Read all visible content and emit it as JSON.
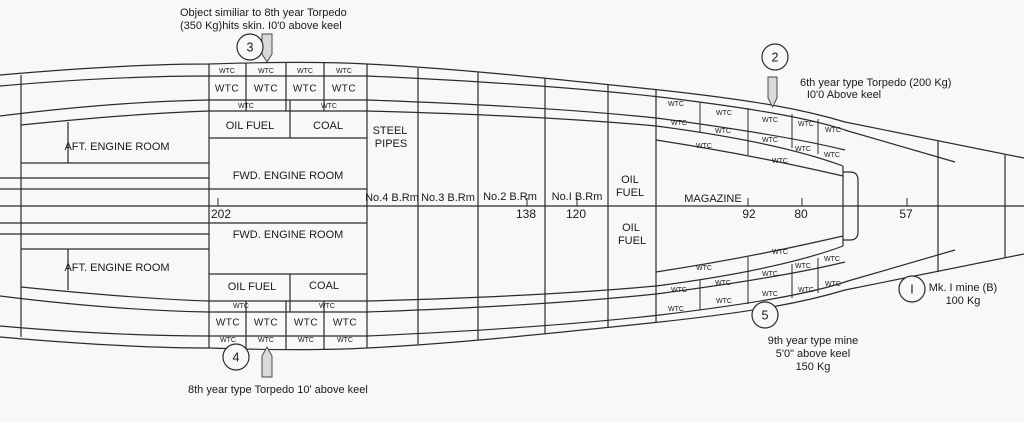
{
  "colors": {
    "bg": "#f8f8f8",
    "line": "#2b2b2b",
    "text": "#1a1a1a",
    "torpedo_fill": "#d9d9d9"
  },
  "compartments": {
    "aft_engine_room_top": "AFT. ENGINE ROOM",
    "aft_engine_room_bottom": "AFT. ENGINE ROOM",
    "fwd_engine_room_top": "FWD. ENGINE ROOM",
    "fwd_engine_room_bottom": "FWD. ENGINE ROOM",
    "oil_fuel_top": "OIL FUEL",
    "coal_top": "COAL",
    "oil_fuel_bottom": "OIL FUEL",
    "coal_bottom": "COAL",
    "steel_pipes_line1": "STEEL",
    "steel_pipes_line2": "PIPES",
    "boiler_room_4": "No.4 B.Rm",
    "boiler_room_3": "No.3 B.Rm",
    "boiler_room_2": "No.2 B.Rm",
    "boiler_room_1": "No.I B.Rm",
    "oil_col_top_line1": "OIL",
    "oil_col_top_line2": "FUEL",
    "oil_col_bottom_line1": "OIL",
    "oil_col_bottom_line2": "FUEL",
    "magazine": "MAGAZINE"
  },
  "frame_numbers": [
    {
      "x": 221,
      "y": 215,
      "t": "202"
    },
    {
      "x": 526,
      "y": 215,
      "t": "138"
    },
    {
      "x": 576,
      "y": 215,
      "t": "120"
    },
    {
      "x": 749,
      "y": 215,
      "t": "92"
    },
    {
      "x": 801,
      "y": 215,
      "t": "80"
    },
    {
      "x": 906,
      "y": 215,
      "t": "57"
    }
  ],
  "wtc_labels": [
    {
      "x": 227,
      "y": 71,
      "t": "WTC",
      "cls": "wtc-xs"
    },
    {
      "x": 266,
      "y": 71,
      "t": "WTC",
      "cls": "wtc-xs"
    },
    {
      "x": 305,
      "y": 71,
      "t": "WTC",
      "cls": "wtc-xs"
    },
    {
      "x": 344,
      "y": 71,
      "t": "WTC",
      "cls": "wtc-xs"
    },
    {
      "x": 227,
      "y": 89,
      "t": "WTC",
      "cls": "wtc-big"
    },
    {
      "x": 266,
      "y": 89,
      "t": "WTC",
      "cls": "wtc-big"
    },
    {
      "x": 305,
      "y": 89,
      "t": "WTC",
      "cls": "wtc-big"
    },
    {
      "x": 344,
      "y": 89,
      "t": "WTC",
      "cls": "wtc-big"
    },
    {
      "x": 246,
      "y": 106,
      "t": "WTC",
      "cls": "wtc-xs"
    },
    {
      "x": 329,
      "y": 106,
      "t": "WTC",
      "cls": "wtc-xs"
    },
    {
      "x": 241,
      "y": 306,
      "t": "WTC",
      "cls": "wtc-xs"
    },
    {
      "x": 327,
      "y": 306,
      "t": "WTC",
      "cls": "wtc-xs"
    },
    {
      "x": 228,
      "y": 323,
      "t": "WTC",
      "cls": "wtc-big"
    },
    {
      "x": 266,
      "y": 323,
      "t": "WTC",
      "cls": "wtc-big"
    },
    {
      "x": 306,
      "y": 323,
      "t": "WTC",
      "cls": "wtc-big"
    },
    {
      "x": 345,
      "y": 323,
      "t": "WTC",
      "cls": "wtc-big"
    },
    {
      "x": 228,
      "y": 340,
      "t": "WTC",
      "cls": "wtc-xs"
    },
    {
      "x": 266,
      "y": 340,
      "t": "WTC",
      "cls": "wtc-xs"
    },
    {
      "x": 306,
      "y": 340,
      "t": "WTC",
      "cls": "wtc-xs"
    },
    {
      "x": 345,
      "y": 340,
      "t": "WTC",
      "cls": "wtc-xs"
    },
    {
      "x": 676,
      "y": 104,
      "t": "WTC",
      "cls": "wtc-xs"
    },
    {
      "x": 724,
      "y": 113,
      "t": "WTC",
      "cls": "wtc-xs"
    },
    {
      "x": 770,
      "y": 120,
      "t": "WTC",
      "cls": "wtc-xs"
    },
    {
      "x": 806,
      "y": 124,
      "t": "WTC",
      "cls": "wtc-xs"
    },
    {
      "x": 833,
      "y": 130,
      "t": "WTC",
      "cls": "wtc-xs"
    },
    {
      "x": 679,
      "y": 123,
      "t": "WTC",
      "cls": "wtc-xs"
    },
    {
      "x": 723,
      "y": 131,
      "t": "WTC",
      "cls": "wtc-xs"
    },
    {
      "x": 770,
      "y": 140,
      "t": "WTC",
      "cls": "wtc-xs"
    },
    {
      "x": 803,
      "y": 149,
      "t": "WTC",
      "cls": "wtc-xs"
    },
    {
      "x": 832,
      "y": 155,
      "t": "WTC",
      "cls": "wtc-xs"
    },
    {
      "x": 704,
      "y": 146,
      "t": "WTC",
      "cls": "wtc-xs"
    },
    {
      "x": 780,
      "y": 161,
      "t": "WTC",
      "cls": "wtc-xs"
    },
    {
      "x": 676,
      "y": 309,
      "t": "WTC",
      "cls": "wtc-xs"
    },
    {
      "x": 724,
      "y": 301,
      "t": "WTC",
      "cls": "wtc-xs"
    },
    {
      "x": 770,
      "y": 294,
      "t": "WTC",
      "cls": "wtc-xs"
    },
    {
      "x": 806,
      "y": 290,
      "t": "WTC",
      "cls": "wtc-xs"
    },
    {
      "x": 833,
      "y": 284,
      "t": "WTC",
      "cls": "wtc-xs"
    },
    {
      "x": 679,
      "y": 290,
      "t": "WTC",
      "cls": "wtc-xs"
    },
    {
      "x": 723,
      "y": 283,
      "t": "WTC",
      "cls": "wtc-xs"
    },
    {
      "x": 770,
      "y": 274,
      "t": "WTC",
      "cls": "wtc-xs"
    },
    {
      "x": 803,
      "y": 266,
      "t": "WTC",
      "cls": "wtc-xs"
    },
    {
      "x": 832,
      "y": 259,
      "t": "WTC",
      "cls": "wtc-xs"
    },
    {
      "x": 704,
      "y": 268,
      "t": "WTC",
      "cls": "wtc-xs"
    },
    {
      "x": 780,
      "y": 252,
      "t": "WTC",
      "cls": "wtc-xs"
    }
  ],
  "annotations": {
    "note3": {
      "num": "3",
      "line1": "Object similiar to 8th year Torpedo",
      "line2": "(350 Kg)hits skin. I0'0 above keel"
    },
    "note2": {
      "num": "2",
      "line1": "6th year type Torpedo (200 Kg)",
      "line2": "I0'0 Above keel"
    },
    "note4": {
      "num": "4",
      "line1": "8th year type Torpedo  10' above keel"
    },
    "note5": {
      "num": "5",
      "line1": "9th year type mine",
      "line2": "5'0\" above keel",
      "line3": "150 Kg"
    },
    "noteI": {
      "num": "I",
      "line1": "Mk. I mine (B)",
      "line2": "100 Kg"
    }
  }
}
